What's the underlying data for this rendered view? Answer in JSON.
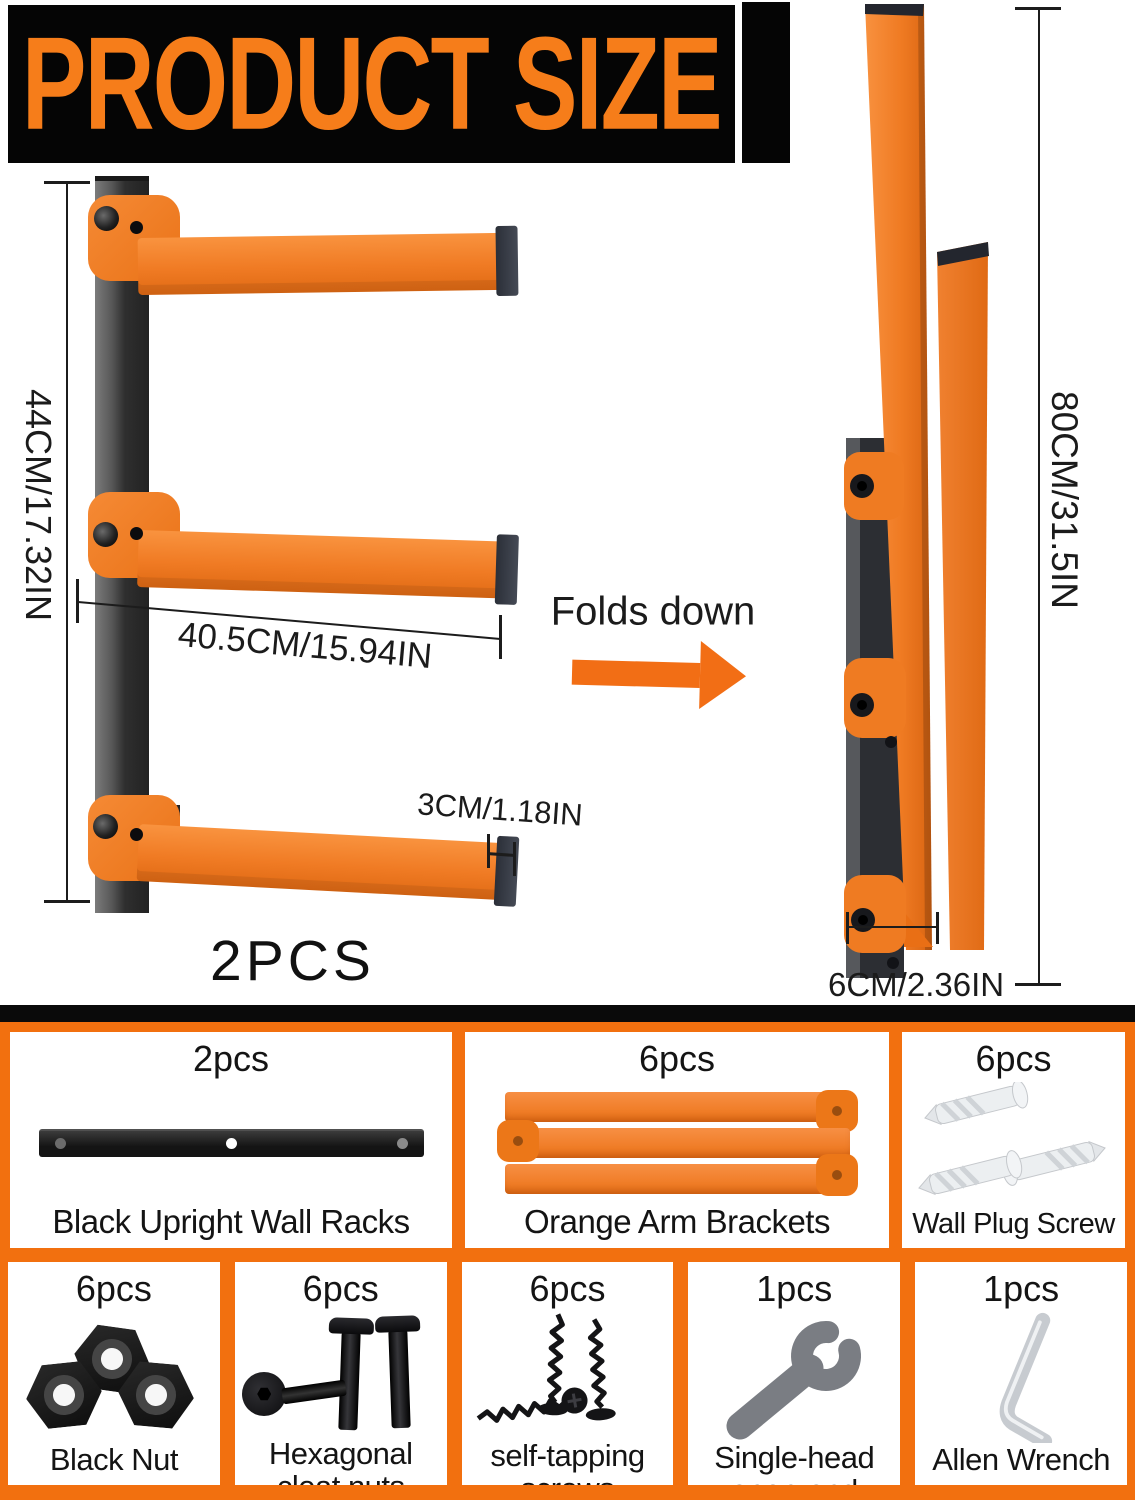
{
  "title": "PRODUCT SIZE",
  "left_diagram": {
    "height_label": "44CM/17.32IN",
    "arm_length_label": "40.5CM/15.94IN",
    "arm_thickness_label": "3CM/1.18IN",
    "quantity_label": "2PCS"
  },
  "fold": {
    "label": "Folds down"
  },
  "right_diagram": {
    "height_label": "80CM/31.5IN",
    "depth_label": "6CM/2.36IN"
  },
  "parts": {
    "row1": [
      {
        "qty": "2pcs",
        "name": "Black Upright Wall Racks",
        "icon": "black-upright-rack-icon"
      },
      {
        "qty": "6pcs",
        "name": "Orange Arm Brackets",
        "icon": "orange-arm-brackets-icon"
      },
      {
        "qty": "6pcs",
        "name": "Wall Plug Screw",
        "icon": "wall-plug-icon"
      }
    ],
    "row2": [
      {
        "qty": "6pcs",
        "name": "Black Nut",
        "icon": "hex-nut-icon"
      },
      {
        "qty": "6pcs",
        "name": "Hexagonal cleat nuts",
        "icon": "cleat-bolt-icon"
      },
      {
        "qty": "6pcs",
        "name": "self-tapping screws",
        "icon": "screw-icon"
      },
      {
        "qty": "1pcs",
        "name": "Single-head open-end wrench",
        "icon": "wrench-icon"
      },
      {
        "qty": "1pcs",
        "name": "Allen Wrench",
        "icon": "allen-wrench-icon"
      }
    ]
  },
  "colors": {
    "accent_orange": "#f2700f",
    "arm_orange": "#f07b24",
    "banner_text_orange": "#f67d1a",
    "black": "#0a0a0a"
  }
}
